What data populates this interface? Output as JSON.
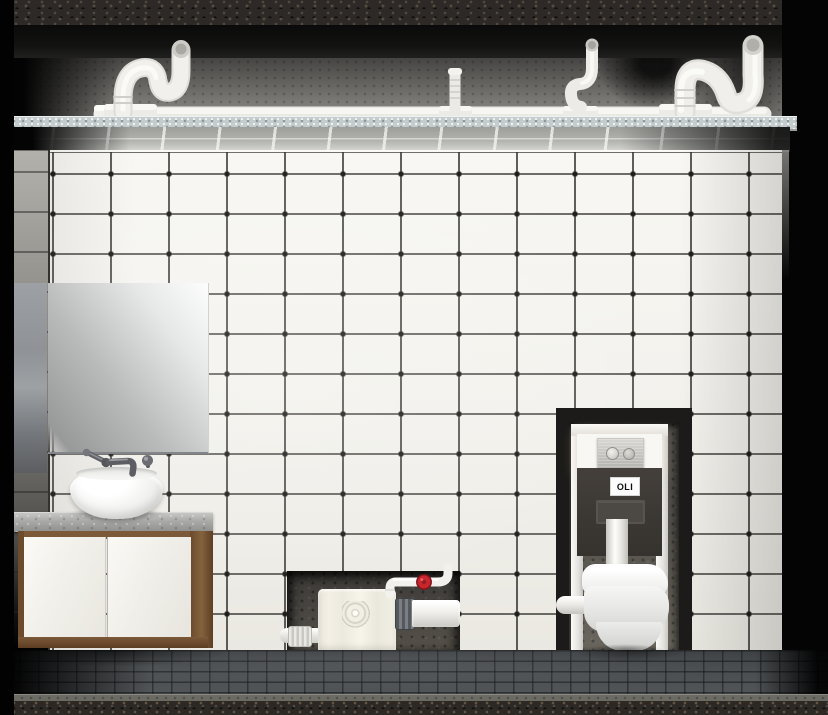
{
  "image": {
    "width_px": 828,
    "height_px": 715,
    "kind": "3D architectural render, cutaway view"
  },
  "scene": {
    "description": "Cutaway bathroom render showing concealed sanitary plumbing: white drain pipes with traps above a suspended ceiling, a white tiled wall with dark grout, a wall-hung vanity with vessel basin and square mirror, a recessed macerator pump unit with red shut-off valve, and a wall-hung toilet mounted on a concealed cistern frame"
  },
  "labels": {
    "cistern_brand": "OLI"
  },
  "colors": {
    "wall_tile": "#f2f1ec",
    "tile_grout": "#34322e",
    "ceiling_underside": "#b2b2af",
    "ceiling_edge": "#c4cccd",
    "concrete_band": "#7d7c78",
    "slab_texture": "#2d2926",
    "pipe_white": "#f0efeb",
    "valve_red": "#c8252c",
    "rubber_coupling": "#55585c",
    "macerator_body": "#efece1",
    "niche_concrete": "#55514c",
    "frame_rail": "#f1f0ed",
    "flush_plate": "#bcbbb7",
    "toilet_white": "#f4f4f2",
    "mirror_sheen": "#e7e8e8",
    "counter_stone": "#a9a9a7",
    "cabinet_wood": "#7b5939",
    "cabinet_door": "#f2f0ea",
    "floor_tile": "#46494c",
    "aggregate_band": "#2c2824",
    "background": "#040404"
  },
  "objects": [
    {
      "name": "ceiling-drain-pipes",
      "detail": "horizontal run with end cap, two S-traps, one zigzag trap, one hose connector"
    },
    {
      "name": "suspended-ceiling",
      "detail": "panel grid underside with speckled front edge"
    },
    {
      "name": "tiled-wall",
      "detail": "white tiles with dark grout and dot intersections"
    },
    {
      "name": "mirror",
      "detail": "frameless square mirror"
    },
    {
      "name": "wall-mounted-faucet",
      "detail": "spout with left lever and right knob"
    },
    {
      "name": "vessel-basin",
      "detail": "round white bowl on stone counter"
    },
    {
      "name": "vanity-cabinet",
      "detail": "wall-hung, wood carcass, two white doors"
    },
    {
      "name": "macerator-pump",
      "detail": "recessed in wall niche, inlet couplings, discharge pipe with red valve"
    },
    {
      "name": "concealed-cistern-frame",
      "detail": "in-wall frame, white access panel, dual-flush plate, OLI tank label"
    },
    {
      "name": "wall-hung-toilet",
      "detail": "white rimless pan with closed seat"
    },
    {
      "name": "floor",
      "detail": "dark grey tile grid over aggregate slab edge"
    }
  ]
}
